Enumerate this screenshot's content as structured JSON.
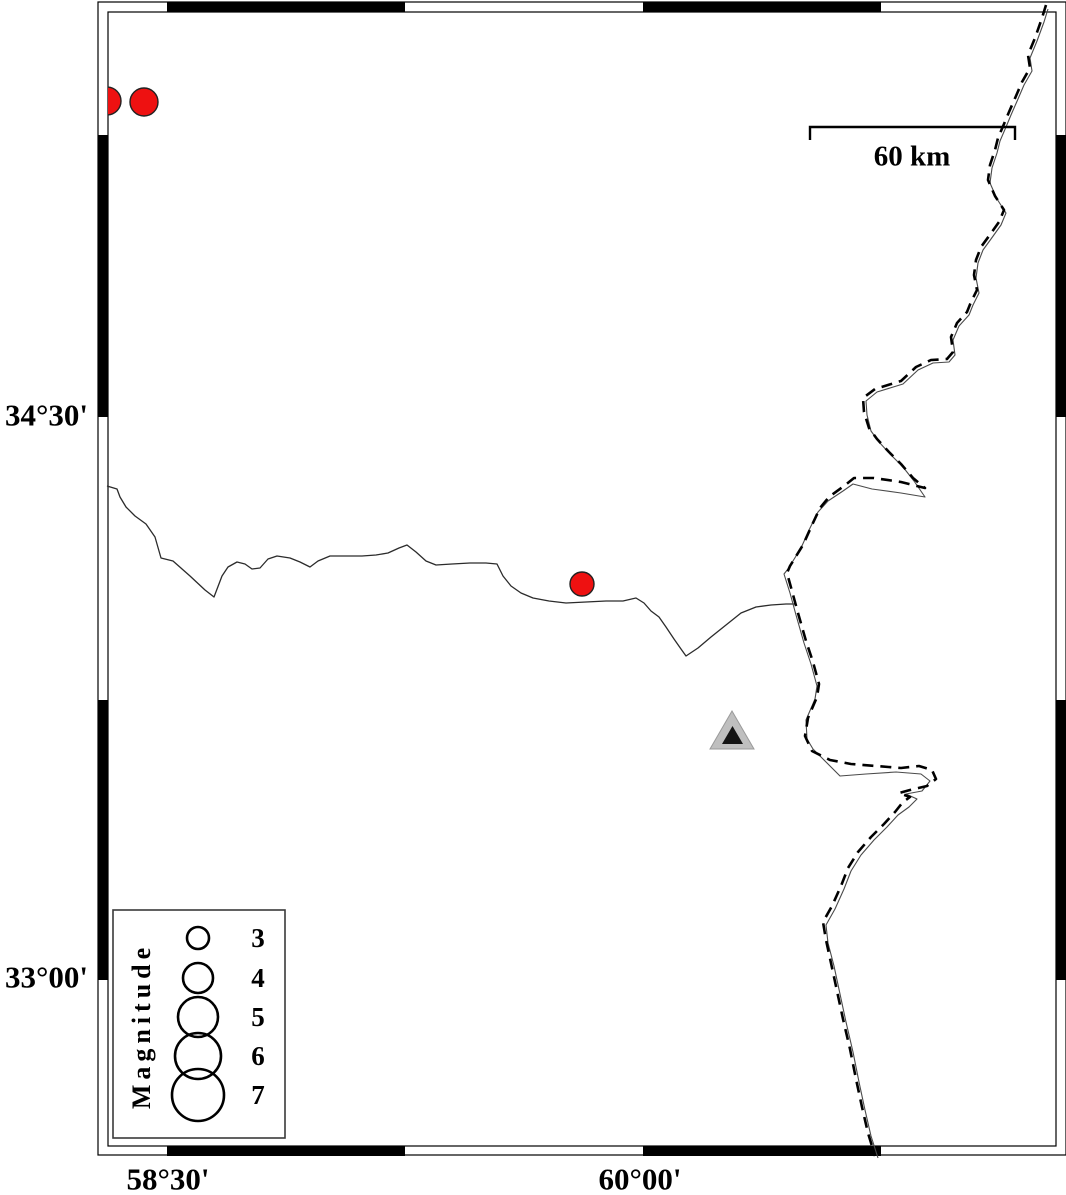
{
  "figure": {
    "width": 1066,
    "height": 1195,
    "background": "#ffffff",
    "frame": {
      "outer": {
        "x": 98,
        "y": 2,
        "w": 968,
        "h": 1153
      },
      "inner": {
        "x": 108,
        "y": 12,
        "w": 948,
        "h": 1134
      },
      "band_black_x_segments": [
        [
          167,
          405
        ],
        [
          643,
          881
        ]
      ],
      "band_black_y_segments": [
        [
          135,
          417
        ],
        [
          700,
          980
        ]
      ],
      "line_color": "#000000",
      "band_black": "#000000",
      "band_white": "#ffffff"
    }
  },
  "axis": {
    "left_labels": [
      {
        "text": "34°30'",
        "x": 88,
        "y": 415
      },
      {
        "text": "33°00'",
        "x": 88,
        "y": 977
      }
    ],
    "bottom_labels": [
      {
        "text": "58°30'",
        "x": 168,
        "y": 1179
      },
      {
        "text": "60°00'",
        "x": 640,
        "y": 1179
      }
    ]
  },
  "scale_bar": {
    "label": "60 km",
    "x1": 810,
    "x2": 1015,
    "y": 127,
    "tick_drop": 13,
    "label_pos": {
      "x": 912,
      "y": 157
    },
    "stroke": "#000000",
    "stroke_width": 2.4
  },
  "legend": {
    "title": "Magnitude",
    "title_pos": {
      "x": 142,
      "y": 1026
    },
    "box": {
      "x": 113,
      "y": 910,
      "w": 172,
      "h": 228,
      "stroke": "#3a3a3a"
    },
    "circle_cx": 198,
    "value_cx": 258,
    "circle_stroke": "#000000",
    "circle_stroke_width": 2.6,
    "entries": [
      {
        "magnitude": "3",
        "cy": 938,
        "r": 11
      },
      {
        "magnitude": "4",
        "cy": 978,
        "r": 15
      },
      {
        "magnitude": "5",
        "cy": 1017,
        "r": 20
      },
      {
        "magnitude": "6",
        "cy": 1056,
        "r": 23
      },
      {
        "magnitude": "7",
        "cy": 1095,
        "r": 26
      }
    ]
  },
  "epicenters": {
    "fill": "#ee1111",
    "stroke": "#222222",
    "stroke_width": 1.4,
    "points": [
      {
        "cx": 107,
        "cy": 101,
        "r": 14
      },
      {
        "cx": 144,
        "cy": 102,
        "r": 14
      },
      {
        "cx": 582,
        "cy": 584,
        "r": 12
      }
    ]
  },
  "station": {
    "outer": {
      "points": "732,711 710,749 754,749",
      "fill": "#bfbfbf",
      "stroke": "#9a9a9a"
    },
    "inner": {
      "points": "732.5,726 722,744 743,744",
      "fill": "#141414"
    }
  },
  "map_lines": {
    "river": {
      "stroke": "#2b2b2b",
      "stroke_width": 1.3,
      "points": [
        [
          107,
          486
        ],
        [
          117,
          489
        ],
        [
          120,
          497
        ],
        [
          126,
          507
        ],
        [
          135,
          516
        ],
        [
          146,
          524
        ],
        [
          155,
          537
        ],
        [
          159,
          551
        ],
        [
          161,
          558
        ],
        [
          173,
          561
        ],
        [
          190,
          576
        ],
        [
          205,
          590
        ],
        [
          214,
          597
        ],
        [
          222,
          576
        ],
        [
          228,
          567
        ],
        [
          237,
          562
        ],
        [
          245,
          564
        ],
        [
          252,
          569
        ],
        [
          260,
          568
        ],
        [
          268,
          559
        ],
        [
          277,
          556
        ],
        [
          290,
          558
        ],
        [
          300,
          562
        ],
        [
          310,
          567
        ],
        [
          318,
          561
        ],
        [
          330,
          556
        ],
        [
          346,
          556
        ],
        [
          362,
          556
        ],
        [
          376,
          555
        ],
        [
          388,
          553
        ],
        [
          399,
          548
        ],
        [
          407,
          545
        ],
        [
          416,
          552
        ],
        [
          426,
          561
        ],
        [
          436,
          565
        ],
        [
          452,
          564
        ],
        [
          470,
          563
        ],
        [
          486,
          563
        ],
        [
          497,
          564
        ],
        [
          503,
          576
        ],
        [
          511,
          586
        ],
        [
          521,
          593
        ],
        [
          533,
          598
        ],
        [
          549,
          601
        ],
        [
          566,
          603
        ],
        [
          586,
          602
        ],
        [
          606,
          601
        ],
        [
          623,
          601
        ],
        [
          636,
          598
        ],
        [
          644,
          603
        ],
        [
          651,
          611
        ],
        [
          659,
          617
        ],
        [
          666,
          627
        ],
        [
          674,
          639
        ],
        [
          681,
          649
        ],
        [
          686,
          656
        ],
        [
          698,
          648
        ],
        [
          711,
          637
        ],
        [
          726,
          625
        ],
        [
          741,
          613
        ],
        [
          756,
          607
        ],
        [
          771,
          605
        ],
        [
          786,
          604
        ],
        [
          796,
          604
        ]
      ]
    },
    "border_dashed": {
      "stroke": "#000000",
      "stroke_width": 2.6,
      "dash": "11 7",
      "points": [
        [
          1046,
          5
        ],
        [
          1042,
          18
        ],
        [
          1035,
          38
        ],
        [
          1028,
          55
        ],
        [
          1030,
          68
        ],
        [
          1022,
          82
        ],
        [
          1016,
          96
        ],
        [
          1009,
          112
        ],
        [
          1004,
          124
        ],
        [
          998,
          138
        ],
        [
          995,
          150
        ],
        [
          990,
          165
        ],
        [
          988,
          180
        ],
        [
          995,
          196
        ],
        [
          1004,
          210
        ],
        [
          999,
          222
        ],
        [
          989,
          236
        ],
        [
          981,
          247
        ],
        [
          976,
          260
        ],
        [
          974,
          275
        ],
        [
          977,
          290
        ],
        [
          971,
          302
        ],
        [
          967,
          312
        ],
        [
          957,
          323
        ],
        [
          951,
          337
        ],
        [
          953,
          352
        ],
        [
          947,
          359
        ],
        [
          931,
          360
        ],
        [
          916,
          367
        ],
        [
          901,
          381
        ],
        [
          875,
          389
        ],
        [
          863,
          398
        ],
        [
          864,
          412
        ],
        [
          869,
          428
        ],
        [
          877,
          439
        ],
        [
          889,
          452
        ],
        [
          901,
          464
        ],
        [
          913,
          478
        ],
        [
          925,
          488
        ],
        [
          901,
          482
        ],
        [
          874,
          478
        ],
        [
          854,
          478
        ],
        [
          844,
          486
        ],
        [
          829,
          497
        ],
        [
          820,
          508
        ],
        [
          812,
          525
        ],
        [
          803,
          545
        ],
        [
          790,
          566
        ],
        [
          787,
          573
        ],
        [
          792,
          591
        ],
        [
          798,
          613
        ],
        [
          806,
          641
        ],
        [
          813,
          662
        ],
        [
          819,
          684
        ],
        [
          817,
          697
        ],
        [
          808,
          718
        ],
        [
          805,
          736
        ],
        [
          812,
          751
        ],
        [
          830,
          760
        ],
        [
          851,
          764
        ],
        [
          876,
          766
        ],
        [
          901,
          768
        ],
        [
          919,
          766
        ],
        [
          932,
          770
        ],
        [
          936,
          779
        ],
        [
          927,
          786
        ],
        [
          910,
          790
        ],
        [
          899,
          793
        ],
        [
          910,
          797
        ],
        [
          903,
          802
        ],
        [
          895,
          812
        ],
        [
          884,
          824
        ],
        [
          871,
          837
        ],
        [
          858,
          852
        ],
        [
          848,
          868
        ],
        [
          841,
          886
        ],
        [
          832,
          906
        ],
        [
          823,
          922
        ],
        [
          826,
          940
        ],
        [
          831,
          963
        ],
        [
          837,
          991
        ],
        [
          843,
          1019
        ],
        [
          850,
          1049
        ],
        [
          856,
          1079
        ],
        [
          862,
          1107
        ],
        [
          868,
          1133
        ],
        [
          875,
          1156
        ]
      ]
    },
    "border_thin": {
      "stroke": "#4a4a4a",
      "stroke_width": 1.1,
      "points": [
        [
          1048,
          9
        ],
        [
          1044,
          22
        ],
        [
          1037,
          41
        ],
        [
          1030,
          58
        ],
        [
          1032,
          71
        ],
        [
          1024,
          85
        ],
        [
          1018,
          99
        ],
        [
          1011,
          115
        ],
        [
          1006,
          127
        ],
        [
          1000,
          141
        ],
        [
          997,
          153
        ],
        [
          992,
          168
        ],
        [
          990,
          183
        ],
        [
          997,
          199
        ],
        [
          1006,
          213
        ],
        [
          1001,
          225
        ],
        [
          991,
          239
        ],
        [
          983,
          250
        ],
        [
          978,
          263
        ],
        [
          976,
          278
        ],
        [
          979,
          293
        ],
        [
          973,
          305
        ],
        [
          969,
          315
        ],
        [
          959,
          326
        ],
        [
          953,
          340
        ],
        [
          955,
          355
        ],
        [
          949,
          362
        ],
        [
          933,
          363
        ],
        [
          918,
          370
        ],
        [
          903,
          384
        ],
        [
          877,
          392
        ],
        [
          866,
          401
        ],
        [
          867,
          415
        ],
        [
          871,
          431
        ],
        [
          879,
          442
        ],
        [
          891,
          455
        ],
        [
          903,
          467
        ],
        [
          914,
          481
        ],
        [
          925,
          497
        ],
        [
          901,
          493
        ],
        [
          872,
          489
        ],
        [
          853,
          484
        ],
        [
          843,
          491
        ],
        [
          828,
          501
        ],
        [
          818,
          512
        ],
        [
          810,
          528
        ],
        [
          801,
          548
        ],
        [
          788,
          569
        ],
        [
          784,
          574
        ],
        [
          790,
          593
        ],
        [
          796,
          615
        ],
        [
          804,
          643
        ],
        [
          811,
          664
        ],
        [
          817,
          686
        ],
        [
          815,
          699
        ],
        [
          806,
          720
        ],
        [
          807,
          739
        ],
        [
          813,
          749
        ],
        [
          822,
          758
        ],
        [
          840,
          776
        ],
        [
          866,
          774
        ],
        [
          896,
          772
        ],
        [
          921,
          774
        ],
        [
          930,
          781
        ],
        [
          922,
          791
        ],
        [
          906,
          794
        ],
        [
          917,
          799
        ],
        [
          909,
          807
        ],
        [
          898,
          815
        ],
        [
          887,
          827
        ],
        [
          874,
          840
        ],
        [
          861,
          855
        ],
        [
          851,
          871
        ],
        [
          844,
          889
        ],
        [
          835,
          909
        ],
        [
          826,
          925
        ],
        [
          828,
          943
        ],
        [
          834,
          966
        ],
        [
          840,
          994
        ],
        [
          846,
          1022
        ],
        [
          853,
          1052
        ],
        [
          859,
          1082
        ],
        [
          865,
          1110
        ],
        [
          871,
          1136
        ],
        [
          878,
          1158
        ]
      ]
    }
  }
}
